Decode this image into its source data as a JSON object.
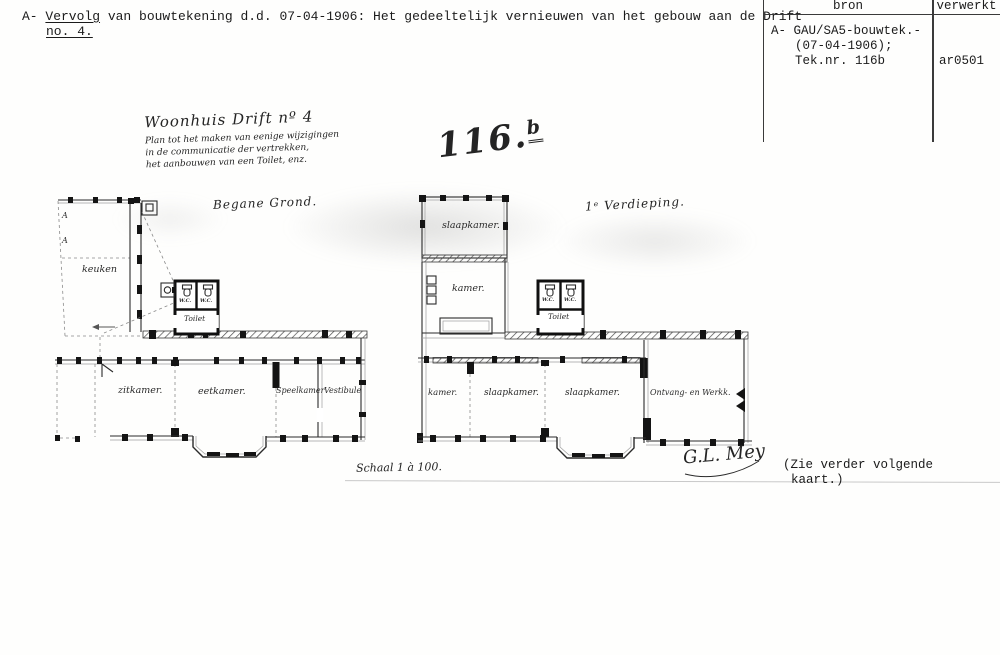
{
  "header": {
    "prefix": "A- ",
    "word_underlined": "Vervolg",
    "rest": " van bouwtekening d.d. 07-04-1906: Het gedeeltelijk vernieuwen van het gebouw aan de Drift",
    "line2": "no. 4."
  },
  "ref_table": {
    "col_source": "bron",
    "col_processed": "verwerkt",
    "source_line1": "A- GAU/SA5-bouwtek.-",
    "source_line2": "(07-04-1906);",
    "source_line3": "Tek.nr. 116b",
    "processed_value": "ar0501"
  },
  "title_block": {
    "title": "Woonhuis Drift nº 4",
    "sub1": "Plan tot het maken van eenige wijzigingen",
    "sub2": "in de communicatie der vertrekken,",
    "sub3": "het aanbouwen van een Toilet, enz."
  },
  "sheet_number": {
    "main": "116",
    "dot": ".",
    "sup": "b"
  },
  "ground_plan": {
    "name": "Begane Grond.",
    "section_a1": "A",
    "section_a2": "A",
    "keuken": "keuken",
    "wc_left": "W.C.",
    "wc_right": "W.C.",
    "toilet": "Toilet",
    "room1": "zitkamer.",
    "room2": "eetkamer.",
    "room3": "Speelkamer",
    "room4": "Vestibule"
  },
  "first_plan": {
    "name": "1ᵉ Verdieping.",
    "room_top": "slaapkamer.",
    "room_mid": "kamer.",
    "wc_left": "W.C.",
    "wc_right": "W.C.",
    "toilet": "Toilet",
    "room1": "kamer.",
    "room2": "slaapkamer.",
    "room3": "slaapkamer.",
    "room4": "Ontvang- en Werkk."
  },
  "footer": {
    "scale": "Schaal 1 à 100.",
    "signature": "G.L. Mey",
    "note_line1": "(Zie verder volgende",
    "note_line2": "kaart.)"
  }
}
